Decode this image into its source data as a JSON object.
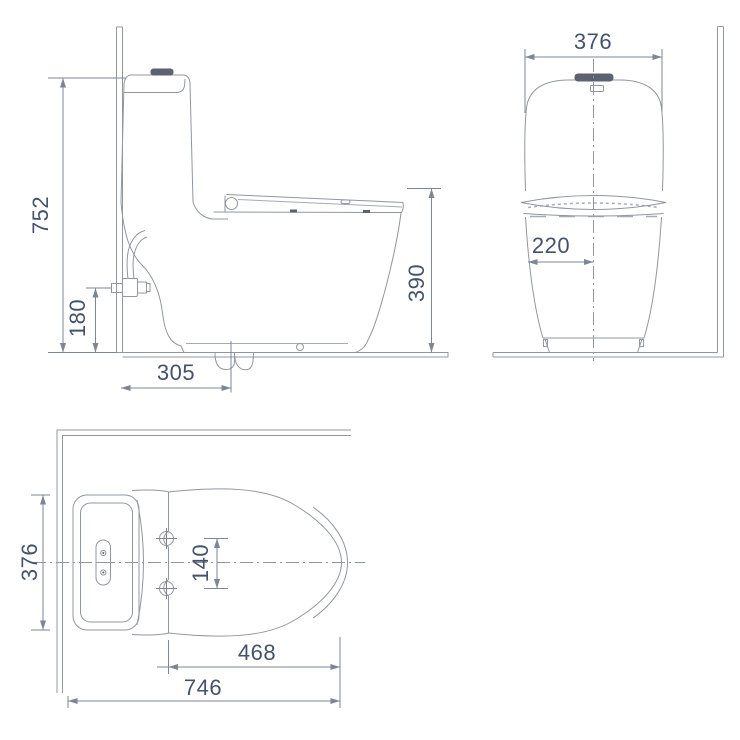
{
  "colors": {
    "bg": "#ffffff",
    "line": "#9097a1",
    "dim": "#7d8694",
    "text": "#44536b",
    "dark": "#5b6270"
  },
  "dimensions": {
    "side_view": {
      "overall_height": "752",
      "inlet_valve_height": "180",
      "outlet_center_from_wall": "305",
      "bowl_rim_height": "390"
    },
    "front_view": {
      "overall_width": "376",
      "center_offset": "220"
    },
    "top_view": {
      "overall_width": "376",
      "seat_hinge_spacing": "140",
      "seat_length": "468",
      "overall_depth": "746"
    }
  }
}
